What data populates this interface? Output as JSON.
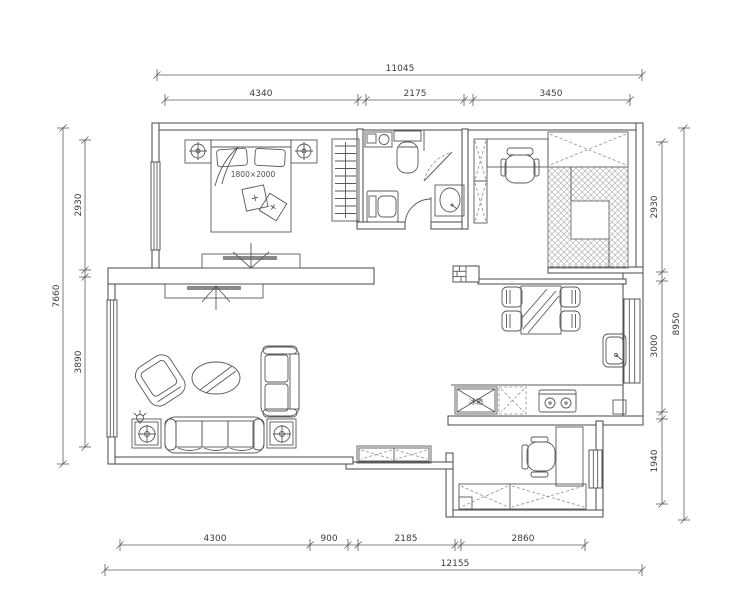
{
  "drawing": {
    "type": "apartment-floor-plan"
  },
  "colors": {
    "background": "#ffffff",
    "wall_line": "#474747",
    "furniture_line": "#585858",
    "dimension_line": "#5c5c5c",
    "dimension_text": "#3c3c3c",
    "tv_screen_fill": "#8a8a8a",
    "hatch": "#b5b5b5"
  },
  "dimensions": {
    "top": {
      "overall": "11045",
      "segments": [
        "4340",
        "2175",
        "3450"
      ]
    },
    "bottom": {
      "overall": "12155",
      "segments": [
        "4300",
        "900",
        "2185",
        "2860"
      ]
    },
    "left": {
      "overall": "7660",
      "segments": [
        "2930",
        "3890"
      ]
    },
    "right": {
      "overall": "8950",
      "segments": [
        "2930",
        "3000",
        "1940"
      ]
    }
  },
  "labels": {
    "bed_size": "1800×2000",
    "fridge": "冰箱"
  }
}
